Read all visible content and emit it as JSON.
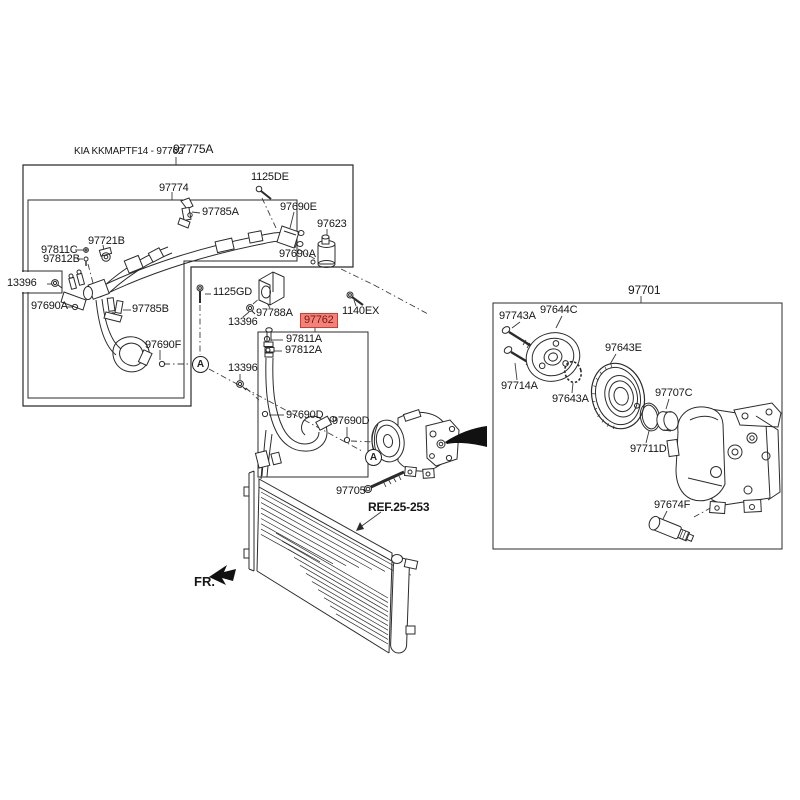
{
  "diagram": {
    "note": "KIA KKMAPTF14 - 97762",
    "selected_part": "97762",
    "highlight": {
      "bg": "#F2837B",
      "border": "#D8382E",
      "text": "#7D150D"
    },
    "line_color": "#2b2b2b"
  },
  "callouts": [
    {
      "id": "kia_note",
      "text": "KIA KKMAPTF14 - 97762"
    },
    {
      "id": "p97775A",
      "text": "97775A"
    },
    {
      "id": "p97774",
      "text": "97774"
    },
    {
      "id": "p1125DE",
      "text": "1125DE"
    },
    {
      "id": "p97785A",
      "text": "97785A"
    },
    {
      "id": "p97690E",
      "text": "97690E"
    },
    {
      "id": "p97623",
      "text": "97623"
    },
    {
      "id": "p97721B",
      "text": "97721B"
    },
    {
      "id": "p97811C",
      "text": "97811C"
    },
    {
      "id": "p97812B",
      "text": "97812B"
    },
    {
      "id": "p13396_a",
      "text": "13396"
    },
    {
      "id": "p97690A_a",
      "text": "97690A"
    },
    {
      "id": "p97785B",
      "text": "97785B"
    },
    {
      "id": "p97690F",
      "text": "97690F"
    },
    {
      "id": "p97690A_b",
      "text": "97690A"
    },
    {
      "id": "p1125GD",
      "text": "1125GD"
    },
    {
      "id": "p13396_b",
      "text": "13396"
    },
    {
      "id": "p97788A",
      "text": "97788A"
    },
    {
      "id": "p97762",
      "text": "97762"
    },
    {
      "id": "p1140EX",
      "text": "1140EX"
    },
    {
      "id": "p97811A",
      "text": "97811A"
    },
    {
      "id": "p97812A",
      "text": "97812A"
    },
    {
      "id": "p13396_c",
      "text": "13396"
    },
    {
      "id": "p97690D_a",
      "text": "97690D"
    },
    {
      "id": "p97690D_b",
      "text": "97690D"
    },
    {
      "id": "p97705",
      "text": "97705"
    },
    {
      "id": "ref",
      "text": "REF.25-253"
    },
    {
      "id": "fr",
      "text": "FR."
    },
    {
      "id": "p97701",
      "text": "97701"
    },
    {
      "id": "p97743A",
      "text": "97743A"
    },
    {
      "id": "p97644C",
      "text": "97644C"
    },
    {
      "id": "p97643E",
      "text": "97643E"
    },
    {
      "id": "p97714A",
      "text": "97714A"
    },
    {
      "id": "p97643A",
      "text": "97643A"
    },
    {
      "id": "p97707C",
      "text": "97707C"
    },
    {
      "id": "p97711D",
      "text": "97711D"
    },
    {
      "id": "p97674F",
      "text": "97674F"
    },
    {
      "id": "amark1",
      "text": "A"
    },
    {
      "id": "amark2",
      "text": "A"
    }
  ]
}
